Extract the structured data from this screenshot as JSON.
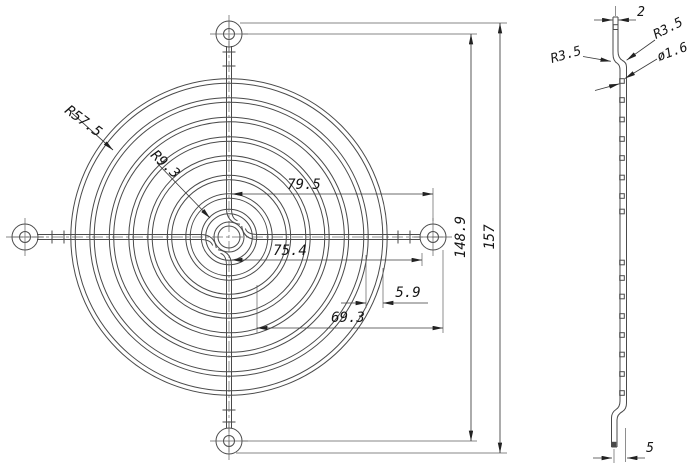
{
  "drawing": {
    "front_view": {
      "radius_outer_label": "R57.5",
      "radius_inner_label": "R9.3",
      "dim_top_half_width": "79.5",
      "dim_bottom_half_width": "75.4",
      "dim_ring_gap": "5.9",
      "dim_inner_span": "69.3",
      "dim_hole_span": "148.9",
      "dim_overall_height": "157"
    },
    "side_view": {
      "dim_thickness": "2",
      "radius_bend_left": "R3.5",
      "radius_bend_right": "R3.5",
      "dim_wire_diameter": "ø1.6",
      "dim_bottom_offset": "5"
    }
  }
}
